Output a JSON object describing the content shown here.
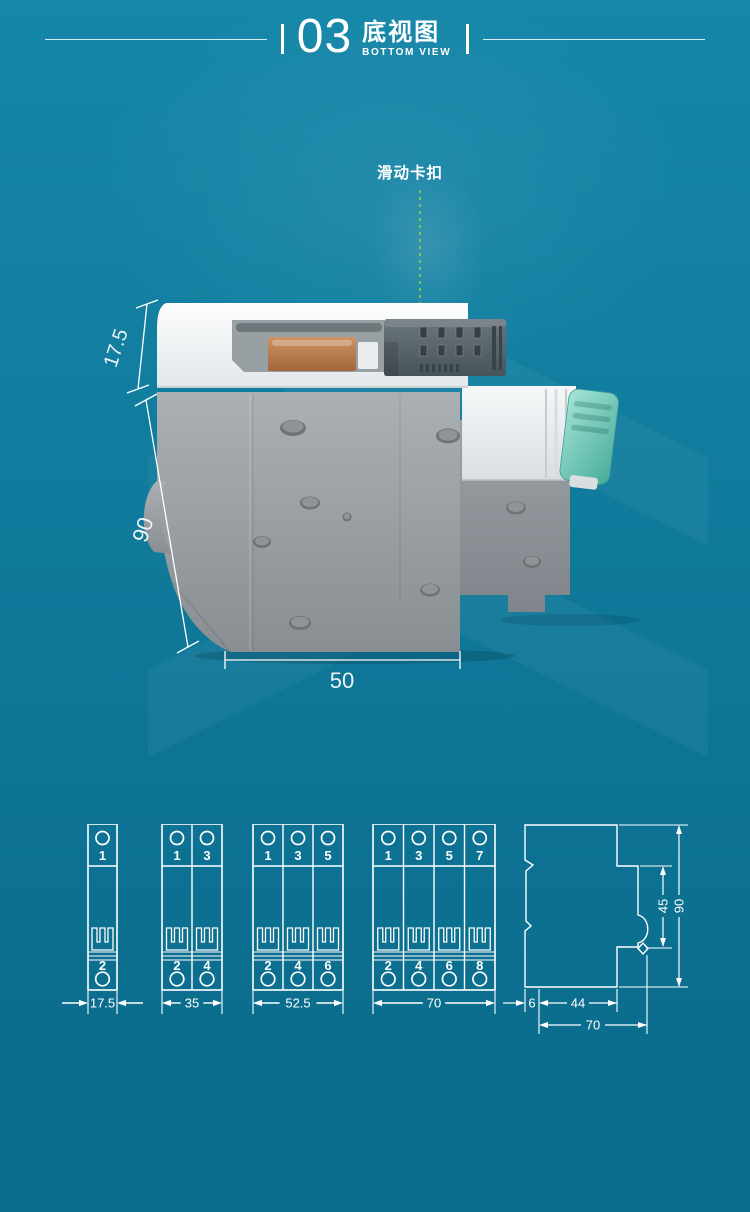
{
  "header": {
    "number": "03",
    "title_cn": "底视图",
    "title_en": "BOTTOM VIEW"
  },
  "callout": {
    "label": "滑动卡扣"
  },
  "product": {
    "dim_top_height": "17.5",
    "dim_body_height": "90",
    "dim_bottom_width": "50"
  },
  "pole_diagrams": [
    {
      "poles": 1,
      "top_terminals": [
        "1"
      ],
      "bottom_terminals": [
        "2"
      ],
      "width_dim": "17.5"
    },
    {
      "poles": 2,
      "top_terminals": [
        "1",
        "3"
      ],
      "bottom_terminals": [
        "2",
        "4"
      ],
      "width_dim": "35"
    },
    {
      "poles": 3,
      "top_terminals": [
        "1",
        "3",
        "5"
      ],
      "bottom_terminals": [
        "2",
        "4",
        "6"
      ],
      "width_dim": "52.5"
    },
    {
      "poles": 4,
      "top_terminals": [
        "1",
        "3",
        "5",
        "7"
      ],
      "bottom_terminals": [
        "2",
        "4",
        "6",
        "8"
      ],
      "width_dim": "70"
    }
  ],
  "side_profile": {
    "dim_clip_height": "45",
    "dim_total_height": "90",
    "dim_front_lip": "6",
    "dim_base_depth": "44",
    "dim_total_depth": "70"
  },
  "colors": {
    "background_top": "#1587a9",
    "background_bottom": "#0b6b8b",
    "line_white": "#ffffff",
    "dotted_green": "#7dc648",
    "lever_teal": "#63c2b2",
    "clip_gray": "#556168"
  }
}
